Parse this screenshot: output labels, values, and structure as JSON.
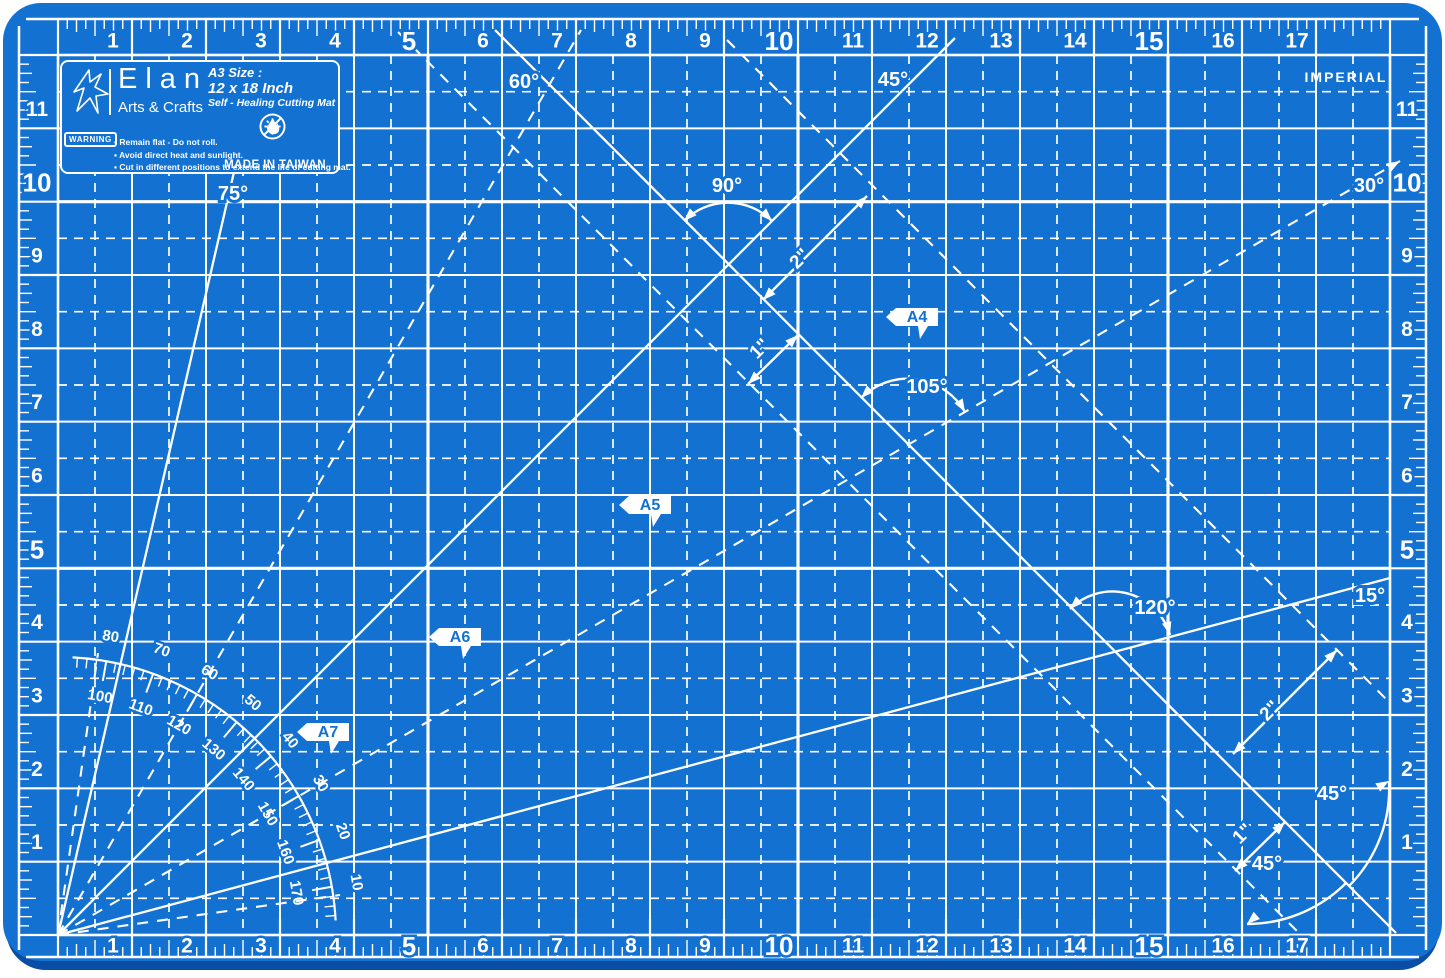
{
  "colors": {
    "mat": "#1371D2",
    "mat_edge": "#0A4DA4",
    "line": "#FFFFFF",
    "label_blue": "#1371D2"
  },
  "unit_label": "IMPERIAL",
  "logo": {
    "brand": "Elan",
    "tagline": "Arts & Crafts",
    "size_title": "A3 Size :",
    "size_value": "12 x 18 Inch",
    "product": "Self - Healing Cutting Mat",
    "warning_badge": "WARNING",
    "warnings": [
      "Remain flat - Do not roll.",
      "Avoid direct heat and sunlight.",
      "Cut in different positions to extend the life of cutting mat."
    ],
    "origin": "MADE IN TAIWAN"
  },
  "rulers": {
    "horizontal": [
      1,
      2,
      3,
      4,
      5,
      6,
      7,
      8,
      9,
      10,
      11,
      12,
      13,
      14,
      15,
      16,
      17
    ],
    "vertical": [
      1,
      2,
      3,
      4,
      5,
      6,
      7,
      8,
      9,
      10,
      11
    ],
    "bold_h": [
      5,
      10,
      15
    ],
    "bold_v": [
      5,
      10
    ]
  },
  "angle_labels": [
    {
      "text": "75°",
      "x": 233,
      "y": 194
    },
    {
      "text": "60°",
      "x": 524,
      "y": 82
    },
    {
      "text": "90°",
      "x": 727,
      "y": 186
    },
    {
      "text": "45°",
      "x": 893,
      "y": 80
    },
    {
      "text": "30°",
      "x": 1369,
      "y": 186
    },
    {
      "text": "105°",
      "x": 927,
      "y": 387
    },
    {
      "text": "120°",
      "x": 1155,
      "y": 608
    },
    {
      "text": "15°",
      "x": 1370,
      "y": 596
    },
    {
      "text": "45°",
      "x": 1332,
      "y": 794
    },
    {
      "text": "45°",
      "x": 1267,
      "y": 864
    }
  ],
  "size_flags": [
    {
      "text": "A4",
      "x": 912,
      "y": 320
    },
    {
      "text": "A5",
      "x": 645,
      "y": 508
    },
    {
      "text": "A6",
      "x": 455,
      "y": 640
    },
    {
      "text": "A7",
      "x": 323,
      "y": 735
    }
  ],
  "measurements": [
    {
      "text": "2\"",
      "x1": 763,
      "y1": 300,
      "x2": 867,
      "y2": 196,
      "lx": 800,
      "ly": 259
    },
    {
      "text": "1\"",
      "x1": 798,
      "y1": 335,
      "x2": 748,
      "y2": 384,
      "lx": 760,
      "ly": 349
    },
    {
      "text": "2\"",
      "x1": 1233,
      "y1": 754,
      "x2": 1337,
      "y2": 650,
      "lx": 1270,
      "ly": 711
    },
    {
      "text": "1\"",
      "x1": 1285,
      "y1": 822,
      "x2": 1235,
      "y2": 871,
      "lx": 1243,
      "ly": 834
    }
  ],
  "protractor": {
    "outer_labels": [
      "80",
      "70",
      "60",
      "50",
      "40",
      "30",
      "20",
      "10"
    ],
    "inner_labels": [
      "100",
      "110",
      "120",
      "130",
      "140",
      "150",
      "160",
      "170"
    ]
  }
}
